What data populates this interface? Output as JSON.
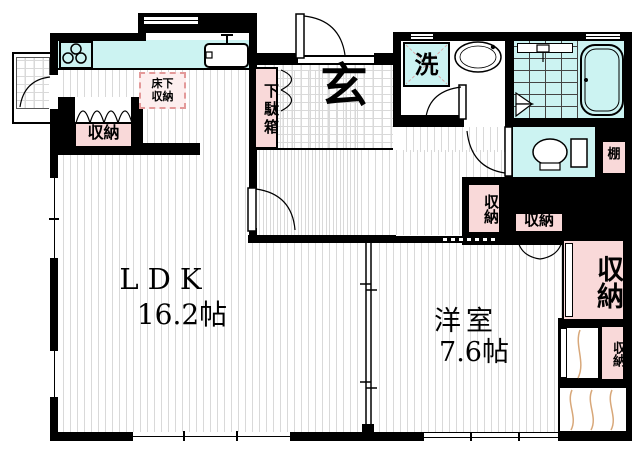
{
  "plan": {
    "rooms": {
      "ldk": {
        "label": "LDK",
        "area": "16.2帖"
      },
      "western_room": {
        "label": "洋室",
        "area": "7.6帖"
      },
      "entrance": {
        "label": "玄"
      }
    },
    "storage": {
      "shoe_cabinet": "下駄箱",
      "underfloor_line1": "床下",
      "underfloor_line2": "収納",
      "closet_kitchen": "収納",
      "closet_hall": "収納",
      "closet_hall2": "収納",
      "closet_east_large": "収納",
      "closet_east_small": "収納",
      "shelf": "棚"
    },
    "utility": {
      "washer": "洗"
    },
    "colors": {
      "wall": "#000000",
      "water_fixture": "#ccf3f2",
      "closet_pink": "#f9d9d9",
      "underfloor_bg": "#fdeeee",
      "underfloor_border": "#e39999",
      "floor_line": "#d9d9d9",
      "curtain_line": "#d8a87a"
    }
  }
}
